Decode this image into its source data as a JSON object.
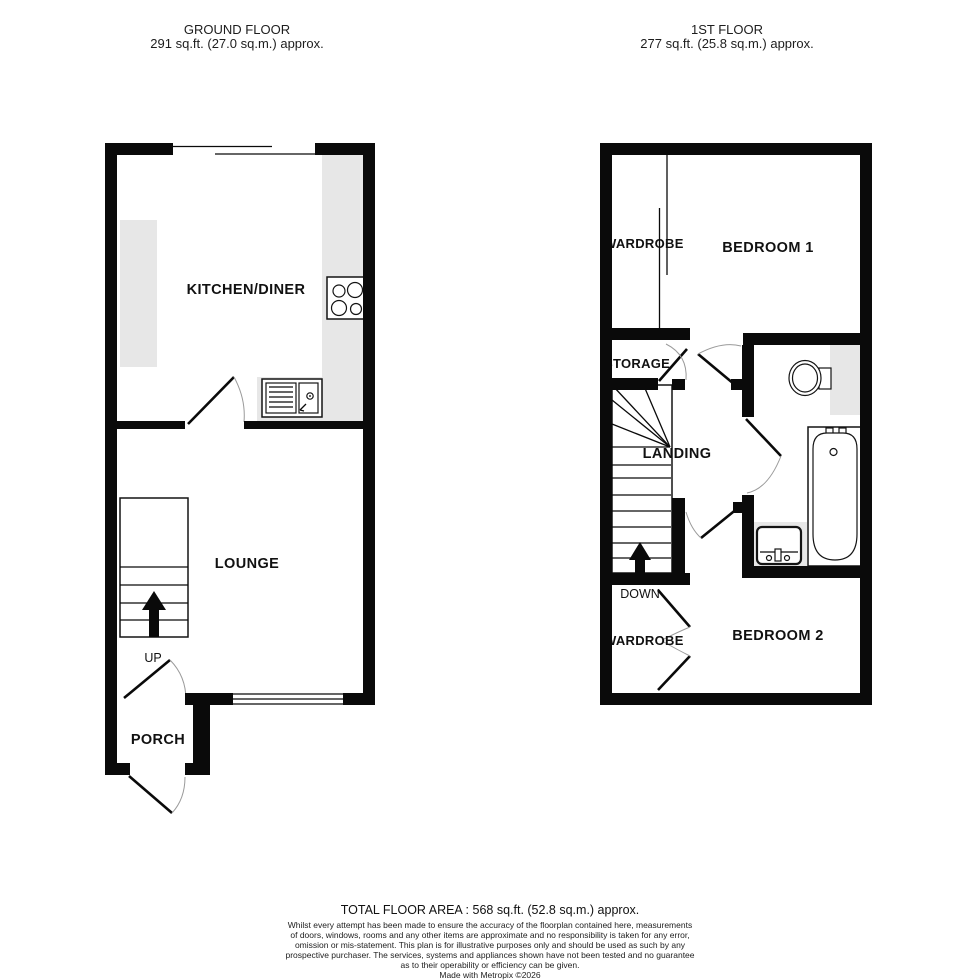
{
  "ground_floor": {
    "title": "GROUND FLOOR",
    "area": "291 sq.ft. (27.0 sq.m.) approx.",
    "rooms": {
      "kitchen": "KITCHEN/DINER",
      "lounge": "LOUNGE",
      "porch": "PORCH"
    },
    "stairs_label": "UP"
  },
  "first_floor": {
    "title": "1ST FLOOR",
    "area": "277 sq.ft. (25.8 sq.m.) approx.",
    "rooms": {
      "wardrobe_top": "WARDROBE",
      "bedroom1": "BEDROOM 1",
      "storage": "STORAGE",
      "landing": "LANDING",
      "wardrobe_bottom": "WARDROBE",
      "bedroom2": "BEDROOM 2"
    },
    "stairs_label": "DOWN"
  },
  "footer": {
    "total_area": "TOTAL FLOOR AREA : 568 sq.ft. (52.8 sq.m.) approx.",
    "disclaimer_lines": [
      "Whilst every attempt has been made to ensure the accuracy of the floorplan contained here, measurements",
      "of doors, windows, rooms and any other items are approximate and no responsibility is taken for any error,",
      "omission or mis-statement. This plan is for illustrative purposes only and should be used as such by any",
      "prospective purchaser. The services, systems and appliances shown have not been tested and no guarantee",
      "as to their operability or efficiency can be given."
    ],
    "credit": "Made with Metropix ©2026"
  },
  "colors": {
    "wall": "#0a0a0a",
    "counter": "#e7e7e7",
    "background": "#ffffff"
  }
}
